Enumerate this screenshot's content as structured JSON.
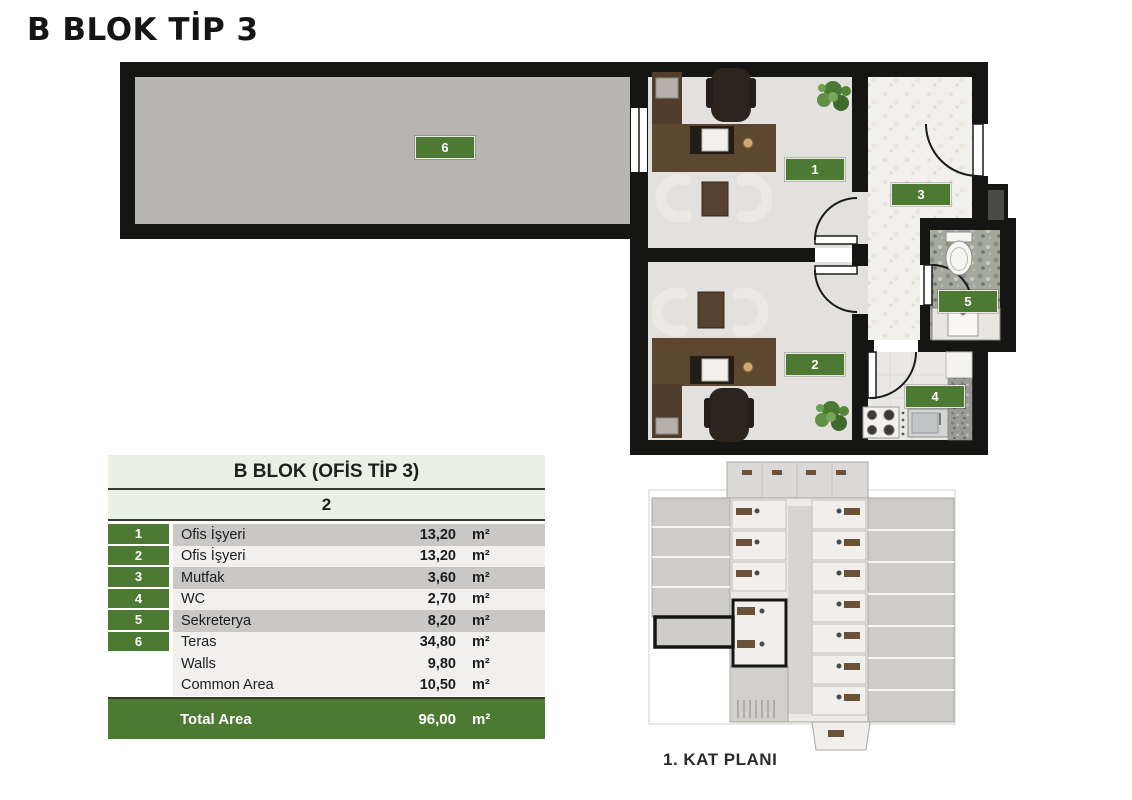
{
  "title": "B BLOK TİP 3",
  "plan": {
    "badges": [
      "1",
      "2",
      "3",
      "4",
      "5",
      "6"
    ]
  },
  "table": {
    "title": "B BLOK (OFİS TİP 3)",
    "subtitle": "2",
    "unit": "m²",
    "rows": [
      {
        "num": "1",
        "label": "Ofis İşyeri",
        "value": "13,20"
      },
      {
        "num": "2",
        "label": "Ofis İşyeri",
        "value": "13,20"
      },
      {
        "num": "3",
        "label": "Mutfak",
        "value": "3,60"
      },
      {
        "num": "4",
        "label": "WC",
        "value": "2,70"
      },
      {
        "num": "5",
        "label": "Sekreterya",
        "value": "8,20"
      },
      {
        "num": "6",
        "label": "Teras",
        "value": "34,80"
      },
      {
        "num": "",
        "label": "Walls",
        "value": "9,80"
      },
      {
        "num": "",
        "label": "Common Area",
        "value": "10,50"
      }
    ],
    "total": {
      "label": "Total Area",
      "value": "96,00"
    }
  },
  "mini_plan": {
    "caption": "1. KAT PLANI"
  },
  "colors": {
    "accent_green": "#4d7a33",
    "light_green": "#e9f1e4",
    "wall_black": "#151513",
    "terrace_gray": "#b6b5b2",
    "office_floor": "#e3e1dd"
  }
}
